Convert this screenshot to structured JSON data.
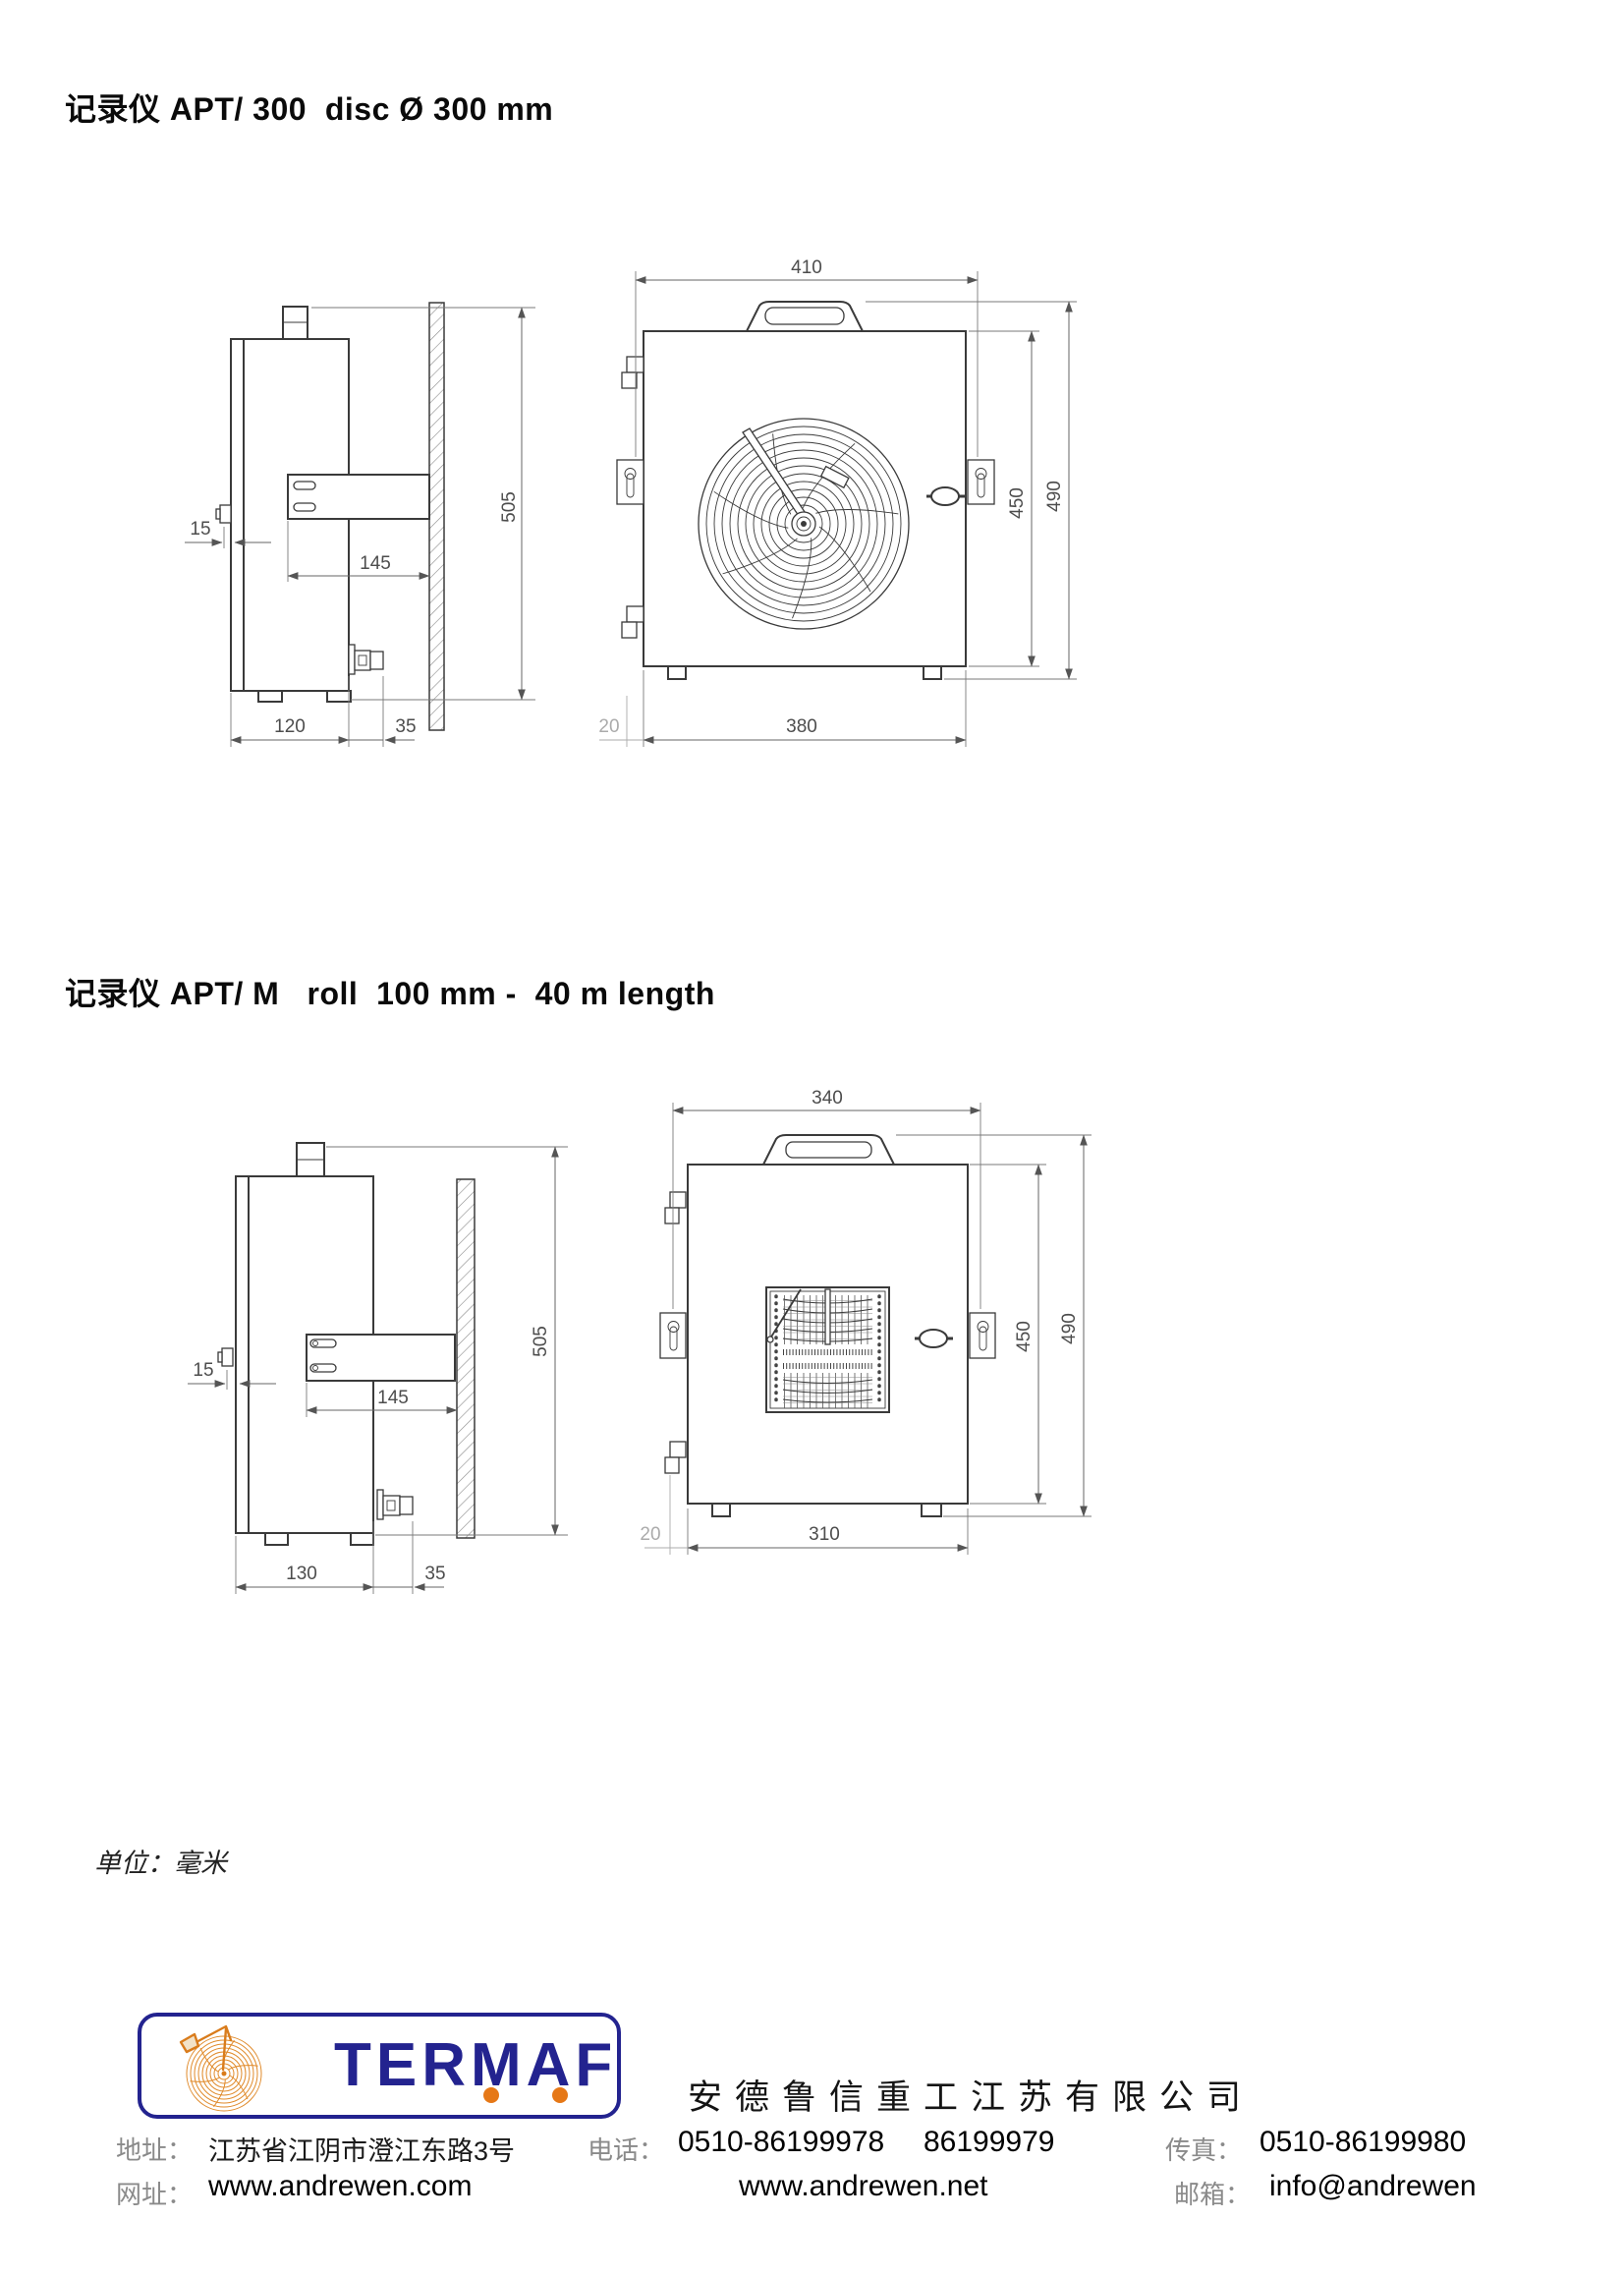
{
  "sections": [
    {
      "title": "记录仪 APT/ 300  disc Ø 300 mm",
      "dims": {
        "door_offset": "15",
        "bracket_depth": "145",
        "total_height": "505",
        "body_depth": "120",
        "wall_gap": "35",
        "top_width": "410",
        "inner_height": "450",
        "overall_height": "490",
        "foot_offset": "20",
        "base_width": "380"
      }
    },
    {
      "title": "记录仪 APT/ M   roll  100 mm -  40 m length",
      "dims": {
        "door_offset": "15",
        "bracket_depth": "145",
        "total_height": "505",
        "body_depth": "130",
        "wall_gap": "35",
        "top_width": "340",
        "inner_height": "450",
        "overall_height": "490",
        "foot_offset": "20",
        "base_width": "310"
      }
    }
  ],
  "units_note": "单位：毫米",
  "logo": {
    "text": "TERMAF"
  },
  "company": {
    "name": "安德鲁信重工江苏有限公司"
  },
  "contact": {
    "address_label": "地址：",
    "address": "江苏省江阴市澄江东路3号",
    "phone_label": "电话：",
    "phone1": "0510-86199978",
    "phone2": "86199979",
    "fax_label": "传真：",
    "fax": "0510-86199980",
    "web_label": "网址：",
    "web1": "www.andrewen.com",
    "web2": "www.andrewen.net",
    "email_label": "邮箱：",
    "email": "info@andrewen"
  },
  "colors": {
    "logo_blue": "#23238f",
    "logo_orange": "#e67817",
    "object_line": "#3a3a3a",
    "dimension_line": "#666666",
    "dimension_light": "#ababab"
  }
}
